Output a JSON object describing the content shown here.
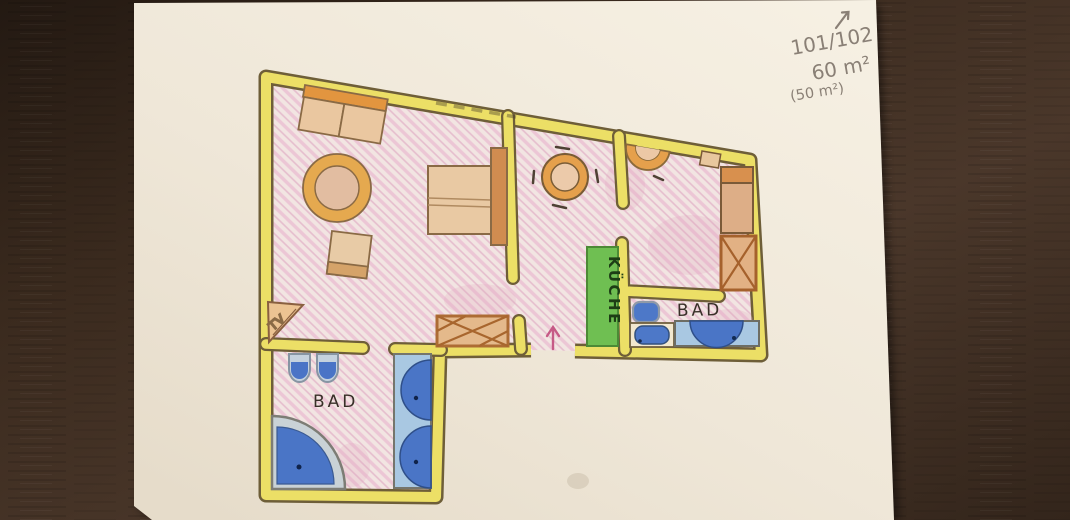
{
  "annotations": {
    "room_numbers": "101/102",
    "area_primary": "60 m²",
    "area_secondary": "(50 m²)",
    "direction_arrow_glyph": "↗",
    "entrance_arrow_glyph": "↑"
  },
  "floor_plan": {
    "labels": {
      "kitchen": "KÜCHE",
      "bathroom_right": "BAD",
      "bathroom_left": "BAD",
      "tv": "TV"
    }
  },
  "colors": {
    "wood_table": "#3d2c20",
    "paper": "#f2ebdd",
    "wall_fill": "#ecdf66",
    "wall_outline": "#6e5e38",
    "floor_pink": "#f1e4e1",
    "floor_hatch": "#e3b4c8",
    "furniture_tan": "#e9c9a3",
    "furniture_orange": "#d8904e",
    "fixture_blue": "#4a75c6",
    "fixture_light_blue": "#a9c8e2",
    "kitchen_green": "#6fbf52",
    "entrance_arrow": "#c65a86",
    "pencil": "#8a8076",
    "label_ink": "#382f28"
  }
}
